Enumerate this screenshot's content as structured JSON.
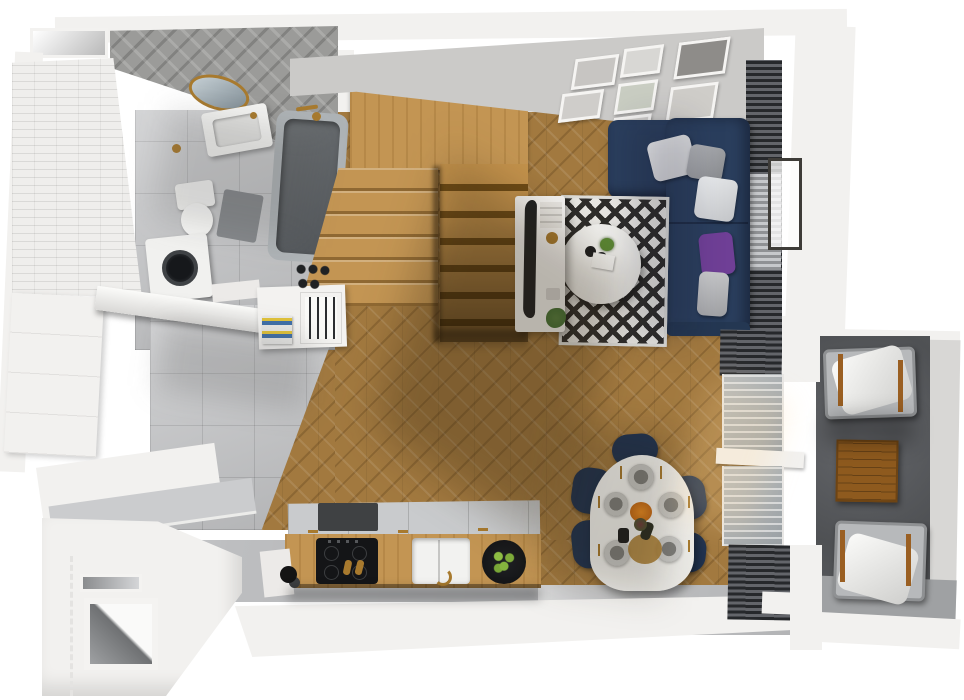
{
  "scene": {
    "label": "3D rendered top-down floor plan of a studio apartment with balcony",
    "colors": {
      "wood-floor": "#a2793f",
      "stair-wood": "#c39553",
      "sofa-navy": "#2a3e5d",
      "chair-navy": "#20324f",
      "accent-purple": "#6f3f96",
      "brass": "#a87a2e",
      "tile-gray": "#c6c7c9",
      "wall-white": "#f2f1ef",
      "wall-gray": "#cbcac8",
      "balcony-concrete": "#595b5e",
      "rug-dark": "#2e2d2b",
      "rug-light": "#e9e8e4",
      "cooktop-black": "#141517",
      "plant-green": "#5d8a35",
      "cushion-white": "#e3e4e6"
    },
    "rooms": {
      "bathroom": {
        "label": "Bathroom",
        "items": [
          "gray bathtub with brass shower",
          "white vanity sink",
          "round brass mirror",
          "toilet",
          "washing machine",
          "gray bath mat",
          "white subway-tile wall",
          "gray herringbone-tile wall"
        ]
      },
      "staircase": {
        "label": "Winder staircase",
        "items": [
          "oak upper landing",
          "left flight of steps",
          "right descending flight"
        ]
      },
      "living": {
        "label": "Living room",
        "items": [
          "navy L-shaped sofa",
          "white, gray and purple cushions",
          "round white coffee table",
          "black-and-white diamond rug",
          "curved TV on white sideboard",
          "gallery wall with 8 white frames",
          "dark venetian blinds",
          "radiator"
        ]
      },
      "dining": {
        "label": "Dining area",
        "items": [
          "white oval table set for five",
          "five navy upholstered chairs",
          "gold cutlery and gray plates",
          "wine bottle, vase and fruit centerpiece"
        ]
      },
      "kitchen": {
        "label": "Kitchen",
        "items": [
          "island with black induction hob",
          "white sink with brass tap",
          "black bowl of green apples",
          "coffee grinder",
          "open cutlery drawer with knives",
          "books",
          "long white counter"
        ]
      },
      "hallway": {
        "label": "Entrance hall",
        "items": [
          "open white door",
          "gray tile floor",
          "wardrobe niche",
          "letter slot"
        ]
      },
      "balcony": {
        "label": "Balcony",
        "items": [
          "two metal lounge chairs with white cushions",
          "square wooden side table",
          "dark concrete floor"
        ]
      }
    }
  }
}
